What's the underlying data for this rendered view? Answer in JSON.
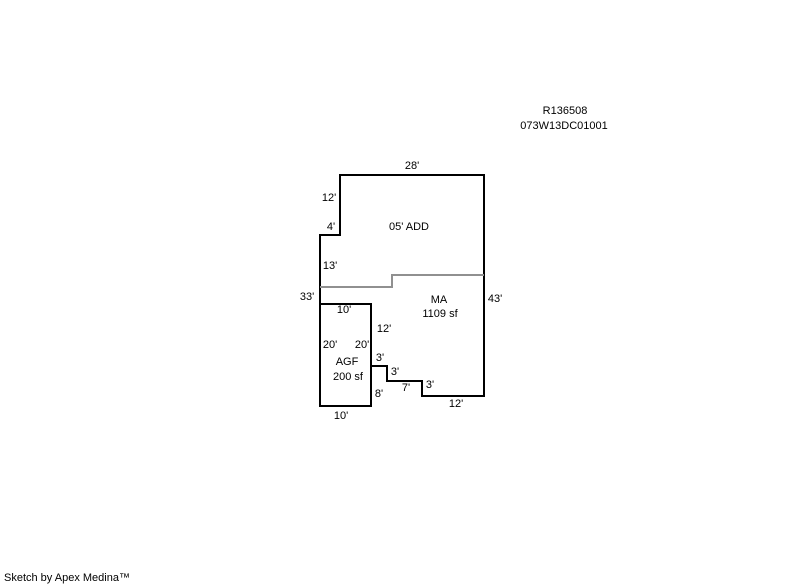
{
  "header": {
    "parcel_id": "R136508",
    "parcel_number": "073W13DC01001",
    "parcel_id_pos": {
      "x": 565,
      "y": 111
    },
    "parcel_number_pos": {
      "x": 564,
      "y": 126
    }
  },
  "footer": {
    "credit": "Sketch by Apex Medina™"
  },
  "sketch": {
    "colors": {
      "wall": "#000000",
      "division_line": "#909090",
      "text": "#000000",
      "background": "#ffffff"
    },
    "stroke_width": 2,
    "shapes": [
      {
        "name": "building-outline",
        "type": "polygon",
        "stroke": "wall",
        "points": [
          [
            340,
            175
          ],
          [
            340,
            235
          ],
          [
            320,
            235
          ],
          [
            320,
            406
          ],
          [
            371,
            406
          ],
          [
            371,
            366
          ],
          [
            387,
            366
          ],
          [
            387,
            381
          ],
          [
            422,
            381
          ],
          [
            422,
            396
          ],
          [
            484,
            396
          ],
          [
            484,
            175
          ]
        ]
      },
      {
        "name": "agf-garage-outline",
        "type": "polygon",
        "stroke": "wall",
        "points": [
          [
            320,
            304
          ],
          [
            371,
            304
          ],
          [
            371,
            406
          ],
          [
            320,
            406
          ]
        ]
      },
      {
        "name": "addition-division-line",
        "type": "polyline",
        "stroke": "division_line",
        "points": [
          [
            320,
            287
          ],
          [
            392,
            287
          ],
          [
            392,
            275
          ],
          [
            484,
            275
          ]
        ]
      }
    ],
    "labels": [
      {
        "kind": "dimension",
        "text": "28'",
        "x": 412,
        "y": 166
      },
      {
        "kind": "dimension",
        "text": "12'",
        "x": 329,
        "y": 198
      },
      {
        "kind": "dimension",
        "text": "4'",
        "x": 331,
        "y": 227
      },
      {
        "kind": "area",
        "text": "05' ADD",
        "x": 409,
        "y": 227
      },
      {
        "kind": "dimension",
        "text": "13'",
        "x": 330,
        "y": 266
      },
      {
        "kind": "dimension",
        "text": "33'",
        "x": 307,
        "y": 297
      },
      {
        "kind": "dimension",
        "text": "43'",
        "x": 495,
        "y": 299
      },
      {
        "kind": "area",
        "text": "MA",
        "x": 439,
        "y": 300
      },
      {
        "kind": "area",
        "text": "1109 sf",
        "x": 440,
        "y": 314
      },
      {
        "kind": "dimension",
        "text": "10'",
        "x": 344,
        "y": 310
      },
      {
        "kind": "dimension",
        "text": "12'",
        "x": 384,
        "y": 329
      },
      {
        "kind": "dimension",
        "text": "20'",
        "x": 330,
        "y": 345
      },
      {
        "kind": "dimension",
        "text": "20'",
        "x": 362,
        "y": 345
      },
      {
        "kind": "area",
        "text": "AGF",
        "x": 347,
        "y": 362
      },
      {
        "kind": "area",
        "text": "200 sf",
        "x": 348,
        "y": 377
      },
      {
        "kind": "dimension",
        "text": "3'",
        "x": 380,
        "y": 358
      },
      {
        "kind": "dimension",
        "text": "3'",
        "x": 395,
        "y": 372
      },
      {
        "kind": "dimension",
        "text": "7'",
        "x": 406,
        "y": 388
      },
      {
        "kind": "dimension",
        "text": "3'",
        "x": 430,
        "y": 385
      },
      {
        "kind": "dimension",
        "text": "8'",
        "x": 379,
        "y": 394
      },
      {
        "kind": "dimension",
        "text": "10'",
        "x": 341,
        "y": 416
      },
      {
        "kind": "dimension",
        "text": "12'",
        "x": 456,
        "y": 404
      }
    ]
  }
}
